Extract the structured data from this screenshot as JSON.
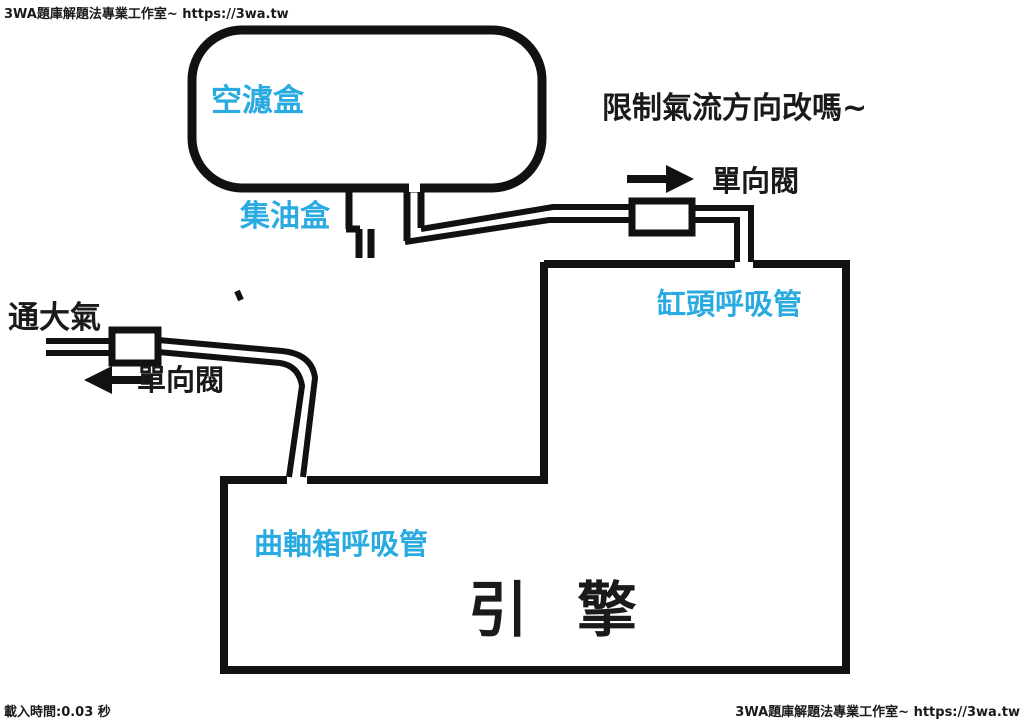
{
  "colors": {
    "line": "#111111",
    "accent": "#29ABE2",
    "text": "#1A1A1A",
    "bg": "#FFFFFF"
  },
  "watermarks": {
    "top_left": "3WA題庫解題法專業工作室~ https://3wa.tw",
    "bottom_right": "3WA題庫解題法專業工作室~ https://3wa.tw",
    "load_time": "載入時間:0.03 秒"
  },
  "diagram": {
    "labels": {
      "air_filter_box": "空濾盒",
      "oil_catch_box": "集油盒",
      "question": "限制氣流方向改嗎~",
      "check_valve_right": "單向閥",
      "cylinder_head_breather": "缸頭呼吸管",
      "vent_to_atmosphere": "通大氣",
      "check_valve_left": "單向閥",
      "crankcase_breather": "曲軸箱呼吸管",
      "engine": "引 擎"
    }
  }
}
